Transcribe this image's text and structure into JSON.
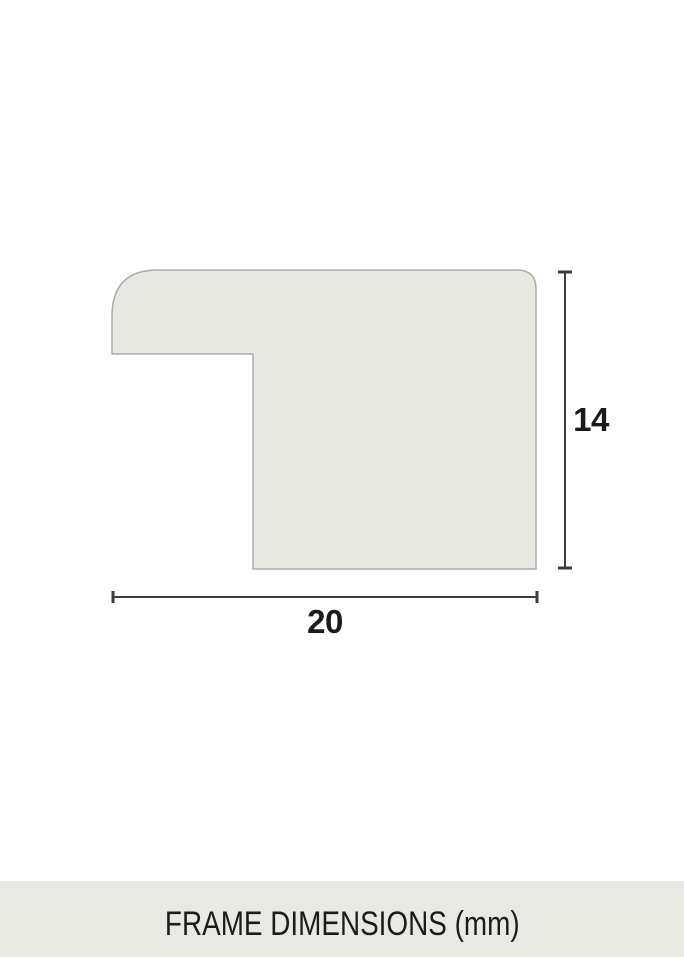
{
  "diagram": {
    "type": "frame-moulding-cross-section",
    "height_label": "14",
    "width_label": "20",
    "height_mm": 14,
    "width_mm": 20
  },
  "caption": {
    "text": "FRAME DIMENSIONS (mm)"
  },
  "colors": {
    "background": "#FFFFFF",
    "profile_fill": "#E8E8E3",
    "profile_stroke": "#ABABA7",
    "dimension_line": "#3D3D3D",
    "label_text": "#1B1B1B",
    "caption_bar_background": "#E9E9E4",
    "caption_text": "#1C1C1C"
  }
}
